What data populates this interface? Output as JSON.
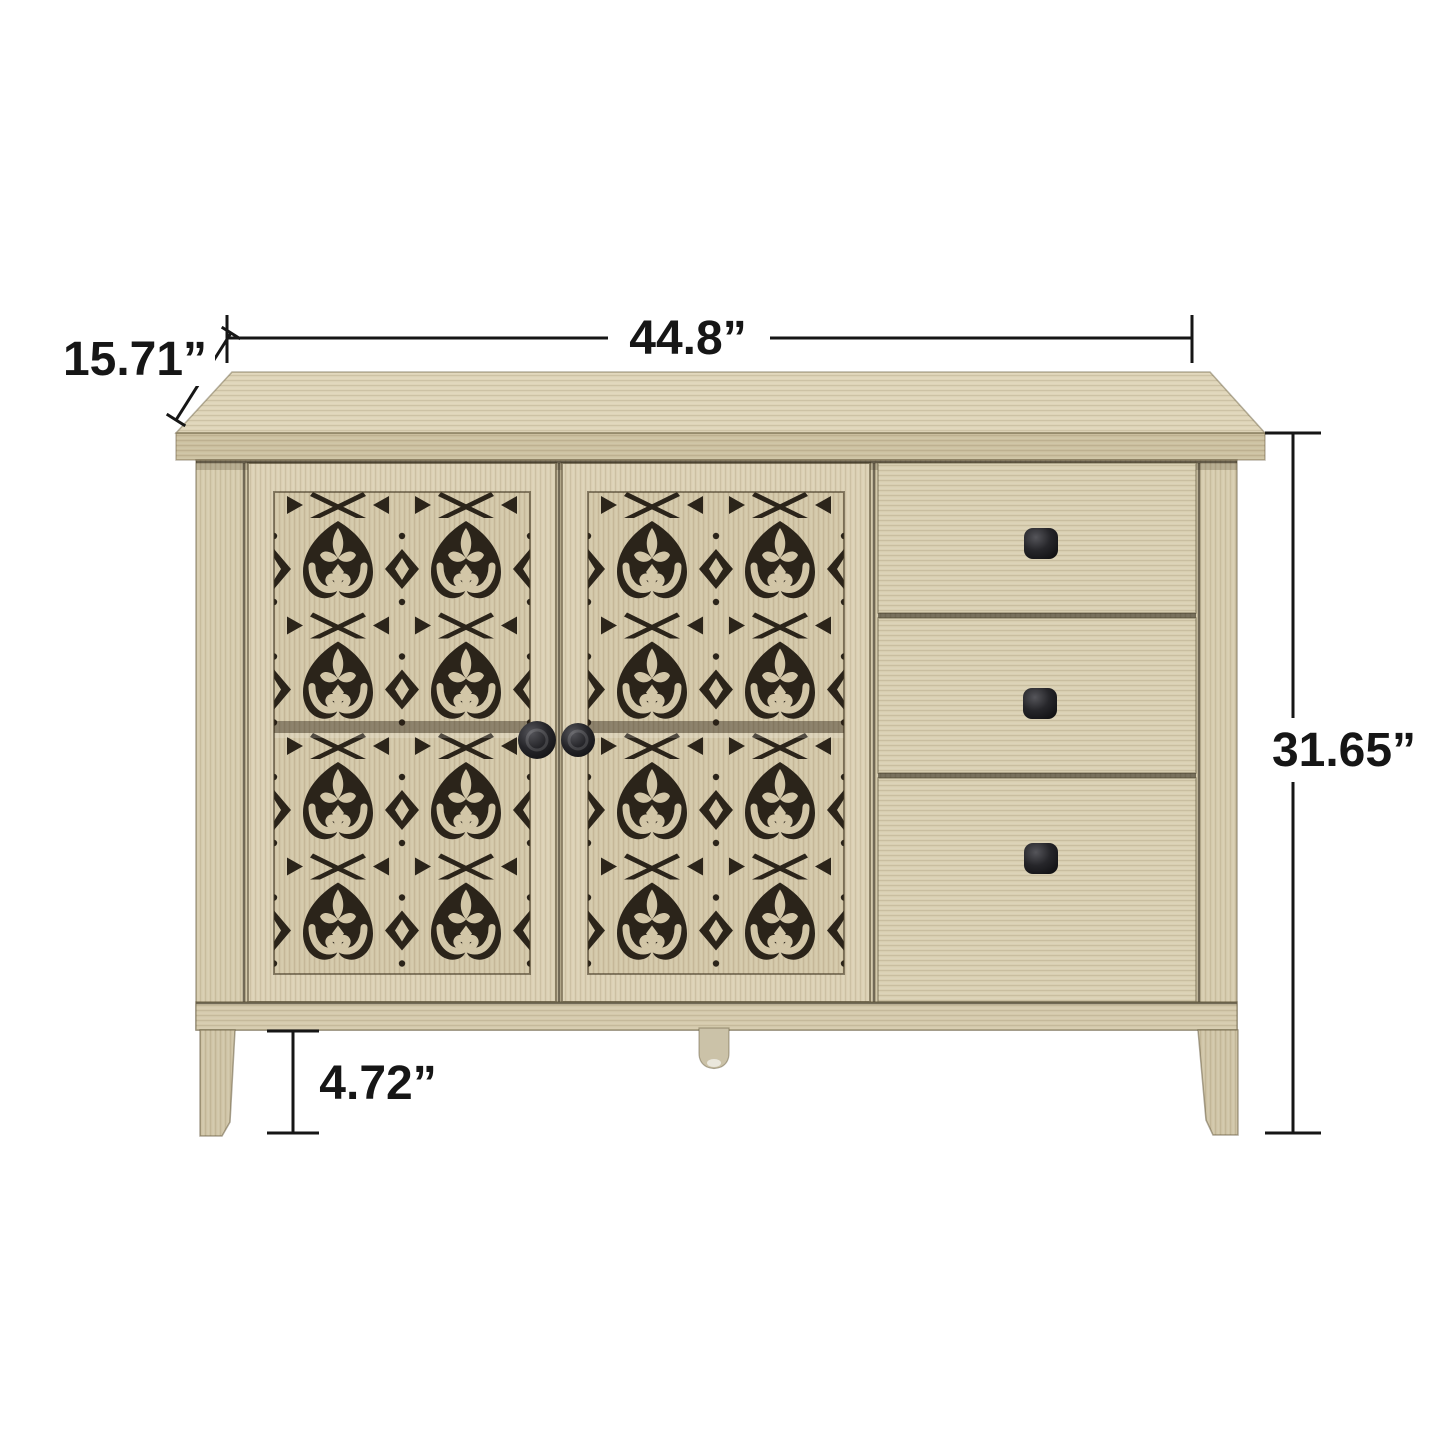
{
  "page": {
    "background": "#ffffff",
    "description_label": "sideboard-dimension-diagram"
  },
  "dimensions": {
    "width": "44.8”",
    "depth": "15.71”",
    "height": "31.65”",
    "leg_height": "4.72”"
  },
  "style": {
    "annotation_color": "#161616",
    "wood_top": "#ded4b8",
    "wood_top_edge": "#cbbf9f",
    "wood_body": "#d6cbad",
    "wood_door_frame": "#dbd0b4",
    "wood_panel": "#d2c6a7",
    "wood_drawer": "#d9cfb2",
    "wood_leg": "#cfc4a6",
    "fretwork_dark": "#2b241a",
    "knob_black": "#141416"
  },
  "components": {
    "doors": 2,
    "drawers": 3,
    "door_knobs": 2,
    "drawer_knobs": 3,
    "legs": 3
  }
}
